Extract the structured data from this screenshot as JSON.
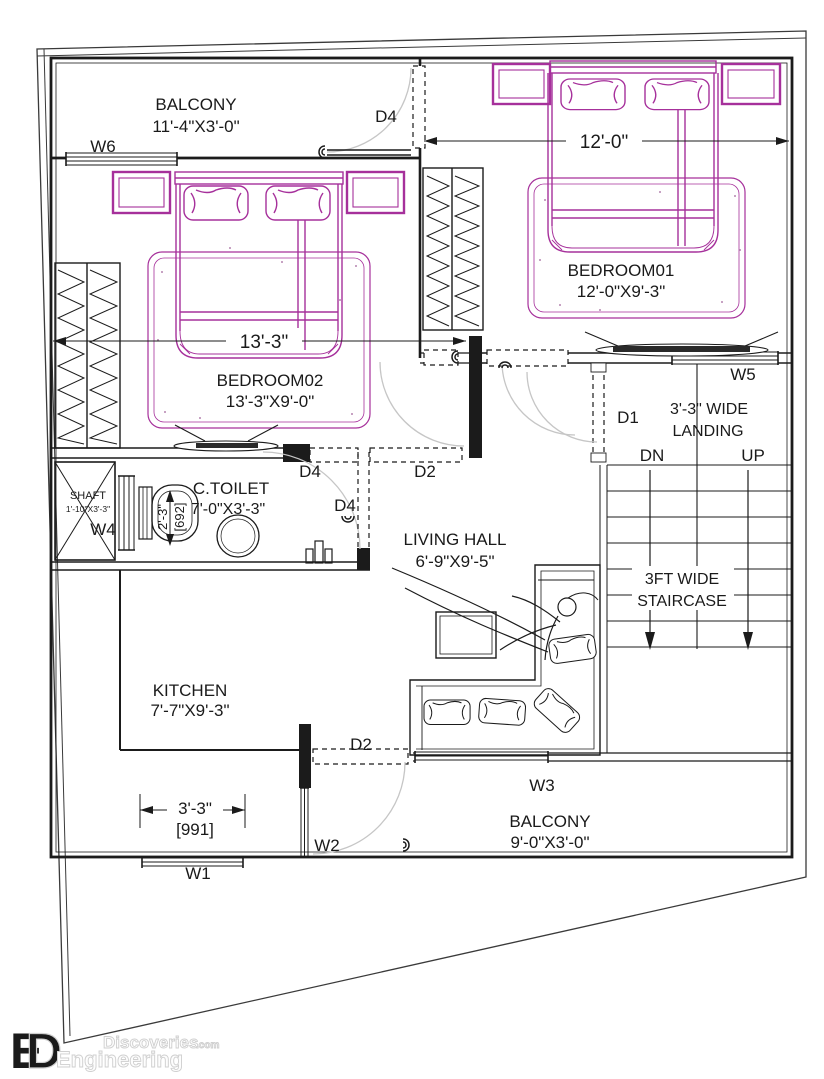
{
  "rooms": {
    "balcony_top": {
      "name": "BALCONY",
      "size": "11'-4\"X3'-0\""
    },
    "bedroom01": {
      "name": "BEDROOM01",
      "size": "12'-0\"X9'-3\""
    },
    "bedroom02": {
      "name": "BEDROOM02",
      "size": "13'-3\"X9'-0\""
    },
    "toilet": {
      "name": "C.TOILET",
      "size": "7'-0\"X3'-3\""
    },
    "shaft": {
      "name": "SHAFT",
      "size": "1'-10\"X3'-3\""
    },
    "living": {
      "name": "LIVING HALL",
      "size": "6'-9\"X9'-5\""
    },
    "kitchen": {
      "name": "KITCHEN",
      "size": "7'-7\"X9'-3\""
    },
    "landing": {
      "line1": "3'-3\" WIDE",
      "line2": "LANDING"
    },
    "staircase": {
      "line1": "3FT WIDE",
      "line2": "STAIRCASE"
    },
    "balcony_bottom": {
      "name": "BALCONY",
      "size": "9'-0\"X3'-0\""
    }
  },
  "doors": {
    "d1": "D1",
    "d2": "D2",
    "d4": "D4"
  },
  "windows": {
    "w1": "W1",
    "w2": "W2",
    "w3": "W3",
    "w4": "W4",
    "w5": "W5",
    "w6": "W6"
  },
  "stairs": {
    "down": "DN",
    "up": "UP"
  },
  "dims": {
    "bedroom01_width": "12'-0\"",
    "bedroom02_width": "13'-3\"",
    "opening_ft": "3'-3\"",
    "opening_mm": "[991]",
    "toilet_ft": "2'-3\"",
    "toilet_mm": "[692]"
  },
  "logo": {
    "line1": "Engineering",
    "line2": "Discoveries",
    "suffix": ".com",
    "mark": "ED"
  },
  "colors": {
    "walls": "#1b1b1b",
    "furniture": "#a6309b",
    "door_arc": "#c6c6c6",
    "logo_yellow": "#f2d117"
  }
}
